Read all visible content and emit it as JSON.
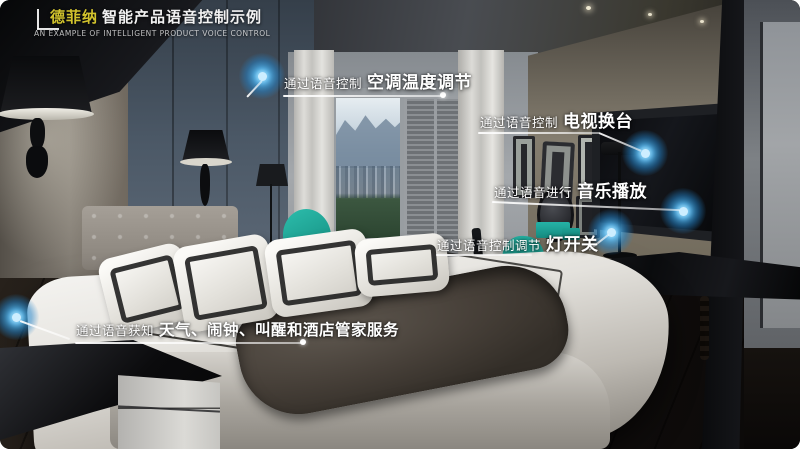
{
  "header": {
    "brand": "德菲纳",
    "title": "智能产品语音控制示例",
    "subtitle": "AN EXAMPLE OF INTELLIGENT PRODUCT VOICE CONTROL"
  },
  "callouts": [
    {
      "id": "ac",
      "prefix": "通过语音控制",
      "label": "空调温度调节"
    },
    {
      "id": "tv",
      "prefix": "通过语音控制",
      "label": "电视换台"
    },
    {
      "id": "music",
      "prefix": "通过语音进行",
      "label": "音乐播放"
    },
    {
      "id": "light",
      "prefix": "通过语音控制调节",
      "label": "灯开关"
    },
    {
      "id": "service",
      "prefix": "通过语音获知",
      "label": "天气、闹钟、叫醒和酒店管家服务"
    }
  ],
  "hotspot_icon": "blue-glow-dot",
  "colors": {
    "brand_yellow": "#d2c32d",
    "hotspot_blue": "#3aa6e0",
    "accent_teal": "#1fae9e",
    "callout_text": "#ffffff"
  }
}
